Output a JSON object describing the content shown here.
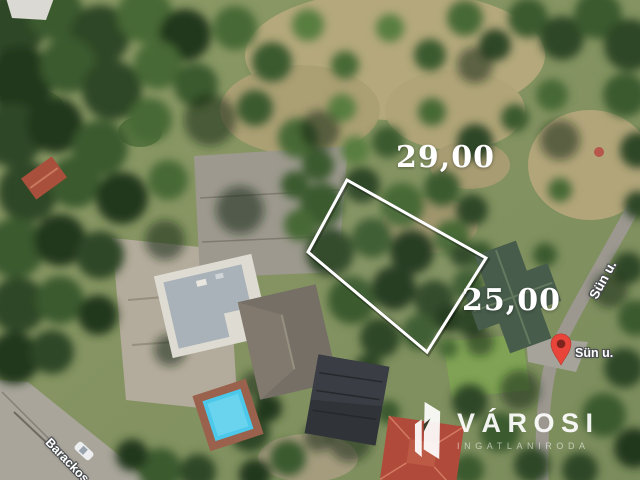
{
  "map": {
    "dimensions": {
      "top": "29,00",
      "right": "25,00"
    },
    "streets": {
      "along_road": "Sün u.",
      "at_pin": "Sün u.",
      "bottom_left": "Barackos"
    },
    "pin": {
      "icon": "red-map-pin"
    }
  },
  "watermark": {
    "brand": "VÁROSI",
    "subtitle": "INGATLANIRODA",
    "icon": "varosi-logo-buildings"
  },
  "colors": {
    "plot_outline": "#ffffff",
    "dimension_text": "#ffffff",
    "pin": "#e8443a",
    "pin_inner": "#7e231d",
    "pool": "#4cc9ea",
    "watermark": "#ffffff"
  }
}
